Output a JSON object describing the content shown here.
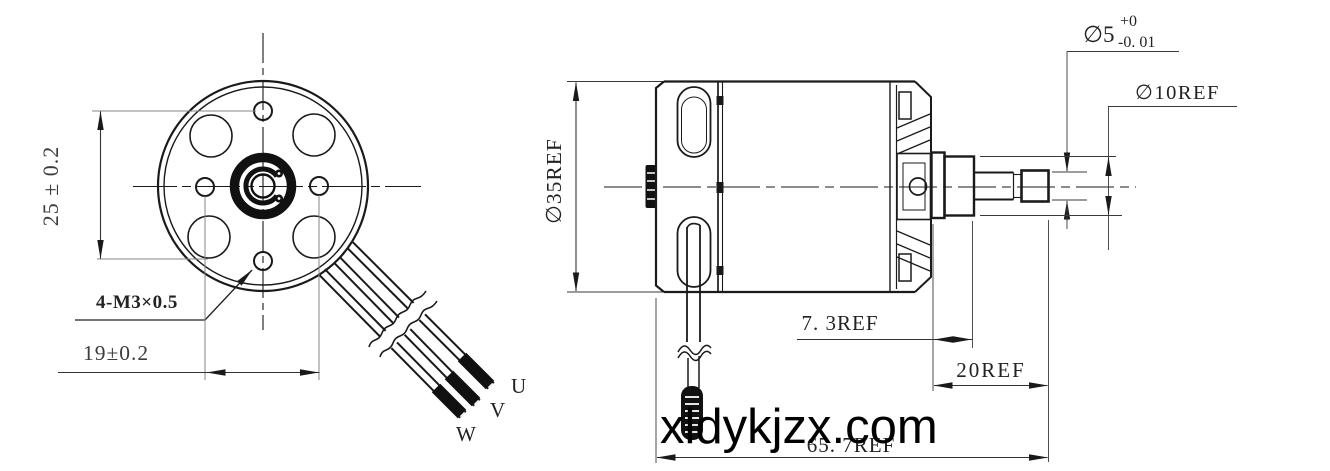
{
  "drawing": {
    "watermark": "xldykjzx.com",
    "front_view": {
      "dim_hole_spacing_vertical": "25 ± 0.2",
      "dim_hole_spacing_horizontal": "19±0.2",
      "thread_callout": "4-M3×0.5",
      "wire_label_u": "U",
      "wire_label_v": "V",
      "wire_label_w": "W"
    },
    "side_view": {
      "dim_body_diameter": "∅35REF",
      "dim_shaft_diameter": "∅5",
      "shaft_tol_upper": "+0",
      "shaft_tol_lower": "-0. 01",
      "dim_collar_diameter": "∅10REF",
      "dim_collar_length": "7. 3REF",
      "dim_shaft_length": "20REF",
      "dim_overall_length": "65. 7REF"
    },
    "colors": {
      "line": "#1a1a1a",
      "dim_line": "#3c3c3c",
      "background": "#ffffff"
    }
  }
}
